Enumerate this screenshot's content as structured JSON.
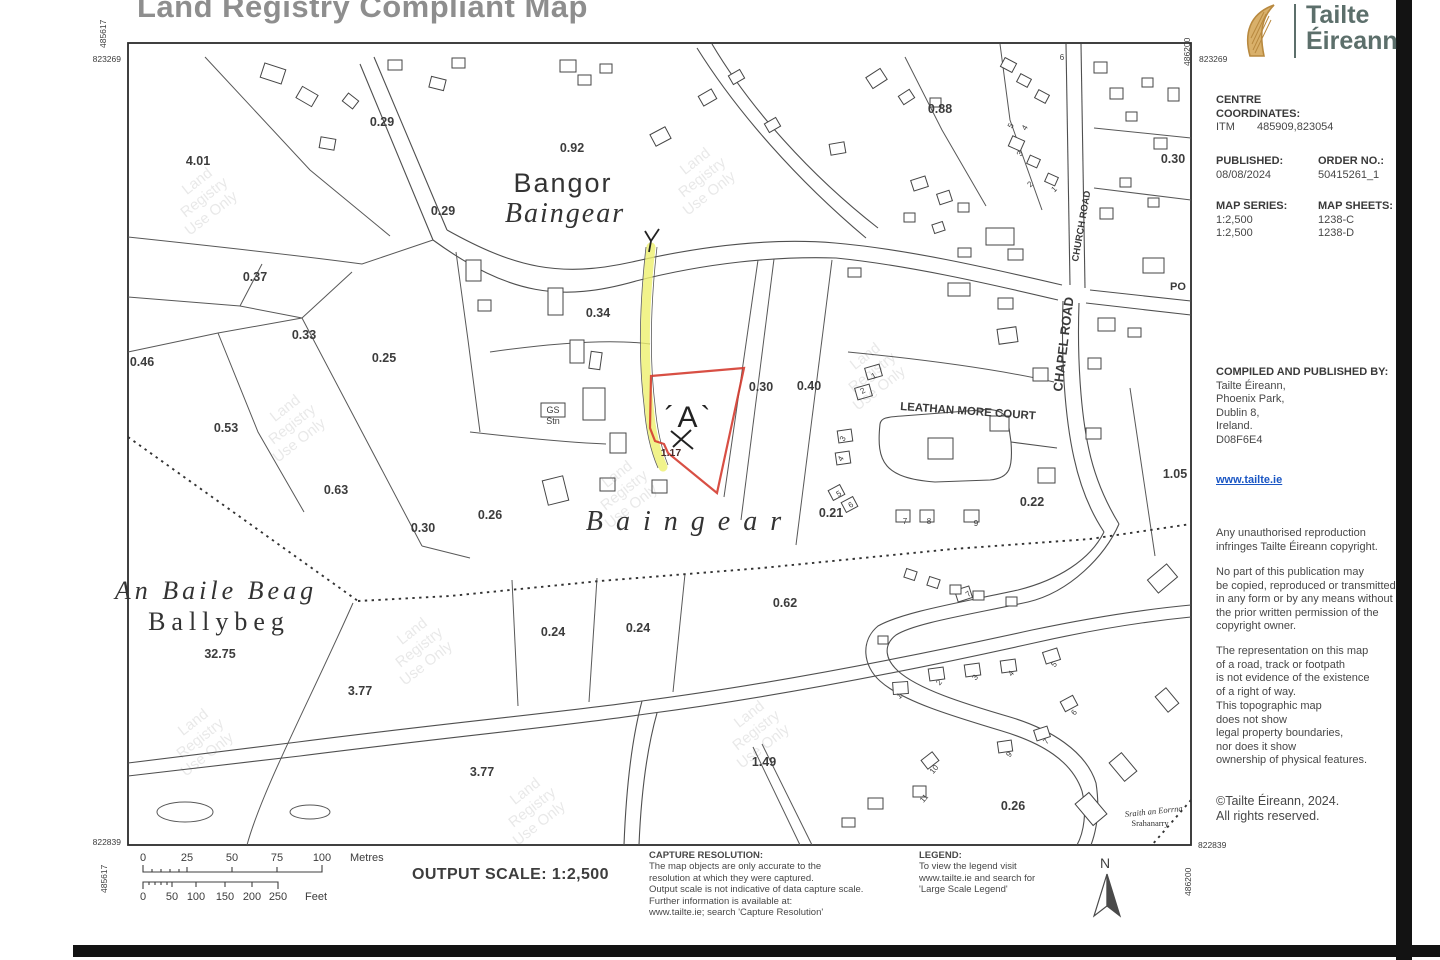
{
  "title": "Land Registry Compliant Map",
  "brand": {
    "logo": "harp-icon",
    "name_line1": "Tailte",
    "name_line2": "Éireann"
  },
  "sidebar": {
    "centre_line1": "CENTRE",
    "centre_line2": "COORDINATES:",
    "itm_label": "ITM",
    "itm_value": "485909,823054",
    "published_label": "PUBLISHED:",
    "published_value": "08/08/2024",
    "order_label": "ORDER NO.:",
    "order_value": "50415261_1",
    "series_label": "MAP SERIES:",
    "series_values": [
      "1:2,500",
      "1:2,500"
    ],
    "sheets_label": "MAP SHEETS:",
    "sheets_values": [
      "1238-C",
      "1238-D"
    ],
    "compiled_heading": "COMPILED AND PUBLISHED BY:",
    "compiled_lines": [
      "Tailte Éireann,",
      "Phoenix Park,",
      "Dublin 8,",
      "Ireland.",
      "D08F6E4"
    ],
    "website": "www.tailte.ie",
    "note_reproduction": [
      "Any unauthorised reproduction",
      "infringes Tailte Éireann copyright."
    ],
    "note_copying": [
      "No part of this publication may",
      "be copied, reproduced or transmitted",
      "in any form or by any means without",
      "the prior written permission of the",
      "copyright owner."
    ],
    "note_row": [
      "The representation on this map",
      "of a road, track or footpath",
      "is not evidence of the existence",
      "of a right of way."
    ],
    "note_topo": [
      "This topographic map",
      "does not show",
      "legal property boundaries,",
      "nor does it show",
      "ownership of physical features."
    ],
    "footer_copyright": [
      "©Tailte Éireann, 2024.",
      "All rights reserved."
    ]
  },
  "footer": {
    "output_scale": "OUTPUT SCALE: 1:2,500",
    "metres_unit": "Metres",
    "feet_unit": "Feet",
    "metres_ticks": [
      "0",
      "25",
      "50",
      "75",
      "100"
    ],
    "feet_ticks": [
      "0",
      "50",
      "100",
      "150",
      "200",
      "250"
    ],
    "capture_heading": "CAPTURE RESOLUTION:",
    "capture_lines": [
      "The map objects are only accurate to the",
      "resolution at which they were captured.",
      "Output scale is not indicative of data capture scale.",
      "Further information is available at:",
      "www.tailte.ie; search 'Capture Resolution'"
    ],
    "legend_heading": "LEGEND:",
    "legend_lines": [
      "To view the legend visit",
      "www.tailte.ie and search for",
      "'Large Scale Legend'"
    ],
    "north_label": "N"
  },
  "map": {
    "grid_labels": [
      {
        "t": "823269",
        "x": 121,
        "y": 62,
        "r": 0,
        "a": "end"
      },
      {
        "t": "485617",
        "x": 106,
        "y": 48,
        "r": -90,
        "a": "start"
      },
      {
        "t": "486200",
        "x": 1190,
        "y": 66,
        "r": -90,
        "a": "start"
      },
      {
        "t": "823269",
        "x": 1199,
        "y": 62,
        "r": 0,
        "a": "start"
      },
      {
        "t": "822839",
        "x": 121,
        "y": 845,
        "r": 0,
        "a": "end"
      },
      {
        "t": "485617",
        "x": 107,
        "y": 893,
        "r": -90,
        "a": "start"
      },
      {
        "t": "822839",
        "x": 1198,
        "y": 848,
        "r": 0,
        "a": "start"
      },
      {
        "t": "486200",
        "x": 1191,
        "y": 896,
        "r": -90,
        "a": "start"
      }
    ],
    "parcel_areas": [
      {
        "t": "4.01",
        "x": 198,
        "y": 165
      },
      {
        "t": "0.29",
        "x": 382,
        "y": 126
      },
      {
        "t": "0.92",
        "x": 572,
        "y": 152
      },
      {
        "t": "0.29",
        "x": 443,
        "y": 215
      },
      {
        "t": "0.88",
        "x": 940,
        "y": 113
      },
      {
        "t": "0.30",
        "x": 1173,
        "y": 163
      },
      {
        "t": "0.37",
        "x": 255,
        "y": 281
      },
      {
        "t": "0.33",
        "x": 304,
        "y": 339
      },
      {
        "t": "0.46",
        "x": 142,
        "y": 366
      },
      {
        "t": "0.25",
        "x": 384,
        "y": 362
      },
      {
        "t": "0.34",
        "x": 598,
        "y": 317
      },
      {
        "t": "0.30",
        "x": 761,
        "y": 391
      },
      {
        "t": "0.40",
        "x": 809,
        "y": 390
      },
      {
        "t": "0.53",
        "x": 226,
        "y": 432
      },
      {
        "t": "0.63",
        "x": 336,
        "y": 494
      },
      {
        "t": "0.30",
        "x": 423,
        "y": 532
      },
      {
        "t": "0.26",
        "x": 490,
        "y": 519
      },
      {
        "t": "0.21",
        "x": 831,
        "y": 517
      },
      {
        "t": "0.22",
        "x": 1032,
        "y": 506
      },
      {
        "t": "1.05",
        "x": 1175,
        "y": 478
      },
      {
        "t": "0.62",
        "x": 785,
        "y": 607
      },
      {
        "t": "0.24",
        "x": 553,
        "y": 636
      },
      {
        "t": "0.24",
        "x": 638,
        "y": 632
      },
      {
        "t": "32.75",
        "x": 220,
        "y": 658
      },
      {
        "t": "3.77",
        "x": 360,
        "y": 695
      },
      {
        "t": "3.77",
        "x": 482,
        "y": 776
      },
      {
        "t": "1.49",
        "x": 764,
        "y": 766
      },
      {
        "t": "0.26",
        "x": 1013,
        "y": 810
      }
    ],
    "place_labels": [
      {
        "t": "Bangor",
        "x": 563,
        "y": 192,
        "s": 27,
        "f": "sans",
        "i": 0,
        "ls": 2,
        "w": 400
      },
      {
        "t": "Baingear",
        "x": 565,
        "y": 222,
        "s": 28,
        "f": "serif",
        "i": 1,
        "ls": 2,
        "w": 400
      },
      {
        "t": "Baingear",
        "x": 690,
        "y": 530,
        "s": 28,
        "f": "serif",
        "i": 1,
        "ls": 13,
        "w": 400
      },
      {
        "t": "An Baile Beag",
        "x": 216,
        "y": 599,
        "s": 26,
        "f": "serif",
        "i": 1,
        "ls": 4,
        "w": 400
      },
      {
        "t": "Ballybeg",
        "x": 219,
        "y": 630,
        "s": 26,
        "f": "serif",
        "i": 0,
        "ls": 6,
        "w": 400
      },
      {
        "t": "Sraith an Eorrna",
        "x": 1154,
        "y": 814,
        "s": 8.5,
        "f": "serif",
        "i": 1,
        "ls": 0,
        "w": 400,
        "r": -6
      },
      {
        "t": "Srahanarry",
        "x": 1150,
        "y": 826,
        "s": 8.5,
        "f": "serif",
        "i": 0,
        "ls": 0,
        "w": 400
      }
    ],
    "street_labels": [
      {
        "t": "LEATHAN MORE COURT",
        "x": 900,
        "y": 410,
        "s": 11.5,
        "r": 4,
        "a": "start"
      },
      {
        "t": "CHURCH ROAD",
        "x": 1078,
        "y": 262,
        "s": 9.5,
        "r": -80,
        "a": "start"
      },
      {
        "t": "CHAPEL ROAD",
        "x": 1062,
        "y": 392,
        "s": 13,
        "r": -83,
        "a": "start"
      },
      {
        "t": "PO",
        "x": 1178,
        "y": 290,
        "s": 11,
        "r": 0,
        "a": "middle"
      },
      {
        "t": "GS",
        "x": 553,
        "y": 413,
        "s": 9,
        "r": 0,
        "a": "middle",
        "w": 400
      },
      {
        "t": "Stn",
        "x": 553,
        "y": 424,
        "s": 9,
        "r": 0,
        "a": "middle",
        "w": 400
      }
    ],
    "house_numbers": [
      {
        "t": "5",
        "x": 1013,
        "y": 127,
        "r": -60
      },
      {
        "t": "4",
        "x": 1027,
        "y": 129,
        "r": -60
      },
      {
        "t": "3",
        "x": 1022,
        "y": 155,
        "r": -60
      },
      {
        "t": "2",
        "x": 1032,
        "y": 186,
        "r": -45
      },
      {
        "t": "1",
        "x": 1056,
        "y": 191,
        "r": -45
      },
      {
        "t": "6",
        "x": 1062,
        "y": 60,
        "r": 0
      },
      {
        "t": "1",
        "x": 875,
        "y": 378,
        "r": -30
      },
      {
        "t": "2",
        "x": 864,
        "y": 393,
        "r": -30
      },
      {
        "t": "3",
        "x": 845,
        "y": 440,
        "r": -60
      },
      {
        "t": "4",
        "x": 843,
        "y": 460,
        "r": -60
      },
      {
        "t": "5",
        "x": 840,
        "y": 496,
        "r": -30
      },
      {
        "t": "6",
        "x": 852,
        "y": 507,
        "r": -30
      },
      {
        "t": "7",
        "x": 905,
        "y": 524,
        "r": 0
      },
      {
        "t": "8",
        "x": 929,
        "y": 524,
        "r": 0
      },
      {
        "t": "9",
        "x": 976,
        "y": 526,
        "r": 0
      },
      {
        "t": "7",
        "x": 970,
        "y": 596,
        "r": -40
      },
      {
        "t": "1",
        "x": 901,
        "y": 698,
        "r": -40
      },
      {
        "t": "2",
        "x": 941,
        "y": 684,
        "r": -50
      },
      {
        "t": "3",
        "x": 977,
        "y": 679,
        "r": -50
      },
      {
        "t": "4",
        "x": 1013,
        "y": 675,
        "r": -50
      },
      {
        "t": "5",
        "x": 1056,
        "y": 666,
        "r": -50
      },
      {
        "t": "6",
        "x": 1076,
        "y": 714,
        "r": -50
      },
      {
        "t": "7",
        "x": 1048,
        "y": 743,
        "r": -50
      },
      {
        "t": "9",
        "x": 1011,
        "y": 756,
        "r": -50
      },
      {
        "t": "10",
        "x": 936,
        "y": 771,
        "r": -50
      },
      {
        "t": "11",
        "x": 926,
        "y": 800,
        "r": -50
      }
    ],
    "marker_label": {
      "t": "´A`",
      "x": 689,
      "y": 427
    },
    "red_area_label": {
      "t": "1.17",
      "x": 671,
      "y": 456
    },
    "watermark_lines": [
      "Land",
      "Registry",
      "Use Only"
    ],
    "watermarks": [
      {
        "x": 200,
        "y": 185,
        "r": -38
      },
      {
        "x": 288,
        "y": 412,
        "r": -38
      },
      {
        "x": 620,
        "y": 478,
        "r": -38
      },
      {
        "x": 415,
        "y": 635,
        "r": -38
      },
      {
        "x": 752,
        "y": 718,
        "r": -38
      },
      {
        "x": 528,
        "y": 795,
        "r": -38
      },
      {
        "x": 868,
        "y": 360,
        "r": -38
      },
      {
        "x": 698,
        "y": 165,
        "r": -38
      },
      {
        "x": 196,
        "y": 726,
        "r": -38
      }
    ],
    "colors": {
      "red_parcel": "#d43c30",
      "yellow_highlight": "#eef06e",
      "link_blue": "#1a56c4",
      "brand_teal": "#5c6f6b",
      "harp_gold": "#c99a55"
    }
  }
}
